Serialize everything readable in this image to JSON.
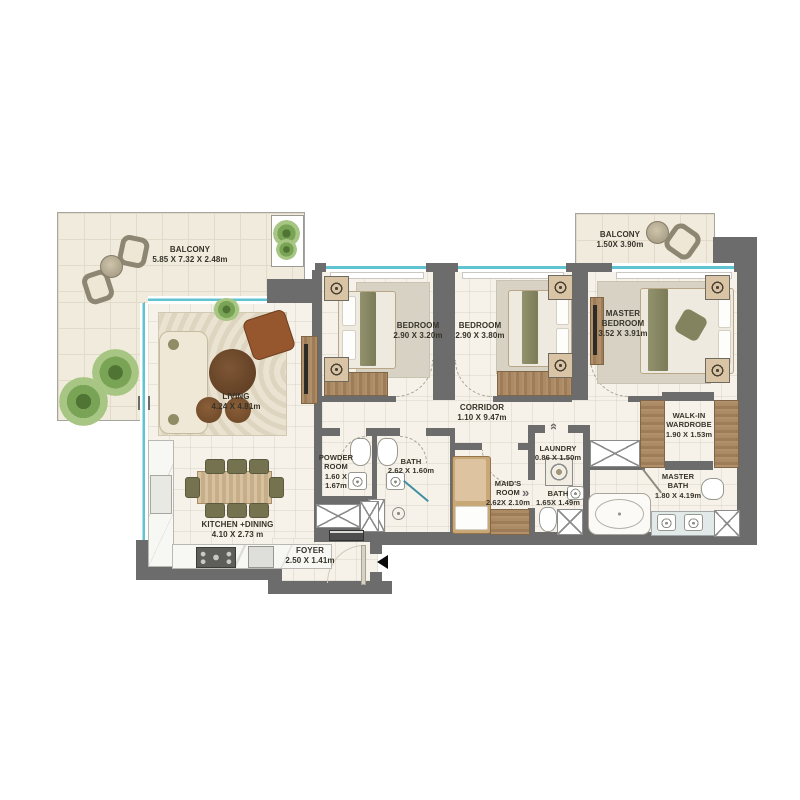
{
  "plan_title": "3 Bedroom Apartment Floor Plan",
  "rooms": {
    "balcony_main": {
      "name": "BALCONY",
      "dims": "5.85 X 7.32 X 2.48m"
    },
    "balcony_master": {
      "name": "BALCONY",
      "dims": "1.50X 3.90m"
    },
    "living": {
      "name": "LIVING",
      "dims": "4.24 X 4.81m"
    },
    "kitchen": {
      "name": "KITCHEN +DINING",
      "dims": "4.10 X 2.73 m"
    },
    "foyer": {
      "name": "FOYER",
      "dims": "2.50 X 1.41m"
    },
    "bedroom1": {
      "name": "BEDROOM",
      "dims": "2.90 X 3.20m"
    },
    "bedroom2": {
      "name": "BEDROOM",
      "dims": "2.90 X 3.80m"
    },
    "master_bedroom": {
      "name": "MASTER BEDROOM",
      "dims": "3.52 X 3.91m"
    },
    "corridor": {
      "name": "CORRIDOR",
      "dims": "1.10 X 9.47m"
    },
    "powder": {
      "name": "POWDER ROOM",
      "dims": "1.60 X 1.67m"
    },
    "bath1": {
      "name": "BATH",
      "dims": "2.62 X 1.60m"
    },
    "maids": {
      "name": "MAID'S ROOM",
      "dims": "2.62X 2.10m"
    },
    "bath2": {
      "name": "BATH",
      "dims": "1.65X 1.49m"
    },
    "laundry": {
      "name": "LAUNDRY",
      "dims": "0.86 X 1.50m"
    },
    "walkin": {
      "name": "WALK-IN WARDROBE",
      "dims": "1.90 X 1.53m"
    },
    "master_bath": {
      "name": "MASTER BATH",
      "dims": "1.80 X 4.19m"
    }
  },
  "palette": {
    "wall": "#6b6c6b",
    "interior_floor": "#f6f2e9",
    "balcony_floor": "#f0ebdd",
    "window": "#5fc3d1",
    "wood": "#a98a66",
    "olive": "#7c7a56",
    "label_text": "#363329",
    "entrance_marker": "#0a0a0a"
  }
}
